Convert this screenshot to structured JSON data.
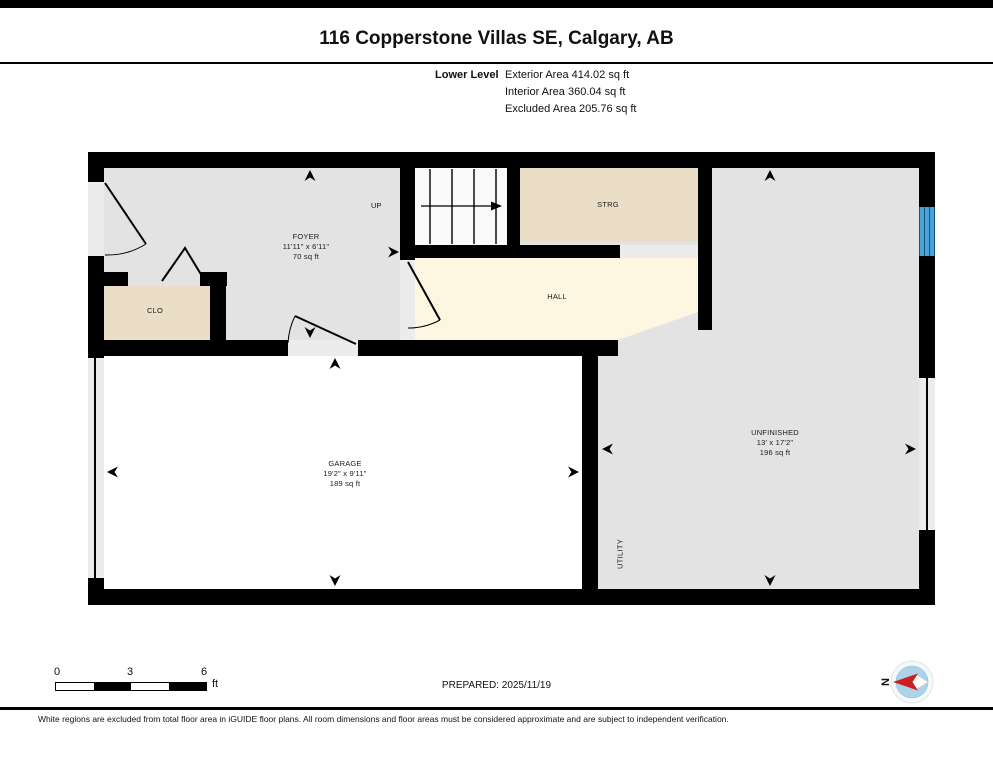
{
  "page": {
    "title": "116 Copperstone Villas SE, Calgary, AB",
    "prepared": "PREPARED: 2025/11/19",
    "disclaimer": "White regions are excluded from total floor area in iGUIDE floor plans. All room dimensions and floor areas must be considered approximate and are subject to independent verification."
  },
  "level_summary": {
    "level": "Lower Level",
    "exterior": "Exterior Area 414.02 sq ft",
    "interior": "Interior Area 360.04 sq ft",
    "excluded": "Excluded Area 205.76 sq ft"
  },
  "rooms": {
    "foyer": {
      "name": "FOYER",
      "dims": "11'11\" x 6'11\"",
      "area": "70 sq ft"
    },
    "clo": {
      "name": "CLO"
    },
    "strg": {
      "name": "STRG"
    },
    "hall": {
      "name": "HALL"
    },
    "garage": {
      "name": "GARAGE",
      "dims": "19'2\" x 9'11\"",
      "area": "189 sq ft"
    },
    "unfinished": {
      "name": "UNFINISHED",
      "dims": "13' x 17'2\"",
      "area": "196 sq ft"
    },
    "utility": {
      "name": "UTILITY"
    }
  },
  "stairs": {
    "label": "UP"
  },
  "scale_bar": {
    "ticks": [
      "0",
      "3",
      "6"
    ],
    "unit": "ft"
  },
  "compass": {
    "north": "N"
  },
  "colors": {
    "wall": "#000000",
    "interior": "#e3e3e3",
    "closet": "#eadfc6",
    "hall": "#fdf6e0",
    "excluded": "#ffffff",
    "window": "#4aa2d8",
    "compass_red": "#c92121"
  }
}
